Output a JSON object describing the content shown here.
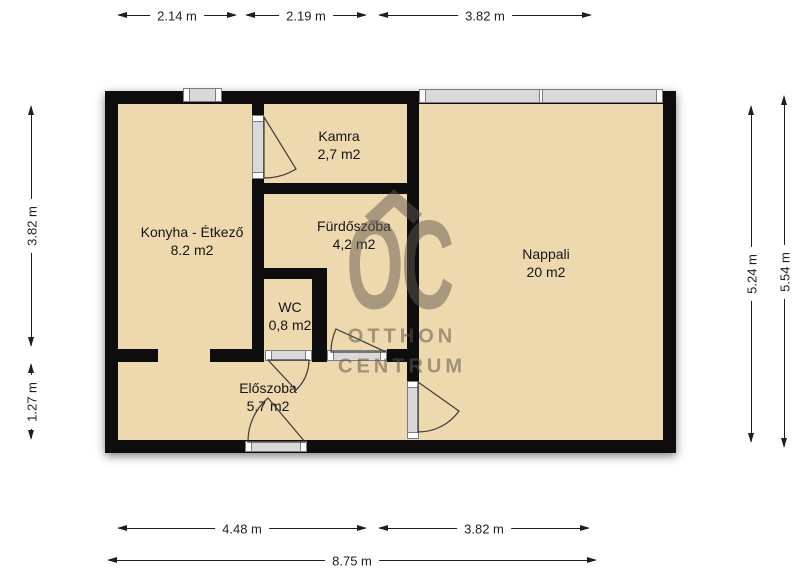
{
  "rooms": [
    {
      "name": "Kamra",
      "area": "2,7 m2"
    },
    {
      "name": "Konyha - Étkező",
      "area": "8.2 m2"
    },
    {
      "name": "Fürdőszoba",
      "area": "4,2 m2"
    },
    {
      "name": "WC",
      "area": "0,8 m2"
    },
    {
      "name": "Nappali",
      "area": "20 m2"
    },
    {
      "name": "Előszoba",
      "area": "5,7 m2"
    }
  ],
  "dimensions": {
    "top": [
      {
        "label": "2.14 m"
      },
      {
        "label": "2.19 m"
      },
      {
        "label": "3.82 m"
      }
    ],
    "bottom": [
      {
        "label": "4.48 m"
      },
      {
        "label": "3.82 m"
      },
      {
        "label": "8.75 m"
      }
    ],
    "left": [
      {
        "label": "3.82 m"
      },
      {
        "label": "1.27 m"
      }
    ],
    "right": [
      {
        "label": "5.24 m"
      },
      {
        "label": "5.54 m"
      }
    ]
  },
  "watermark": {
    "logo": "OC",
    "line1": "OTTHON",
    "line2": "CENTRUM"
  },
  "colors": {
    "floor": "#EED9AE",
    "wall": "#0D0D0D",
    "dimension": "#1F1F1F",
    "watermark": "#5F584E",
    "window": "#D9D9D9"
  }
}
